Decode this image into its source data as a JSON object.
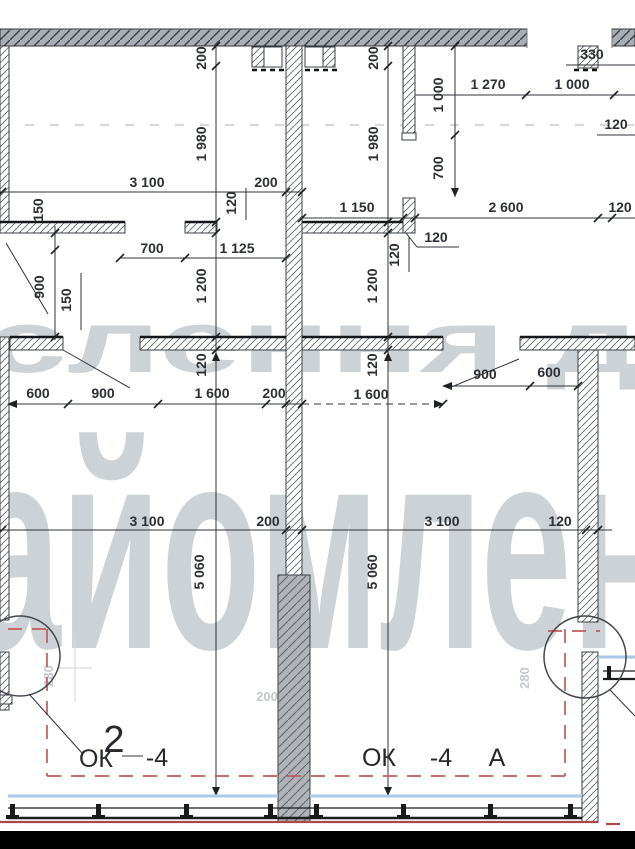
{
  "drawing": {
    "type": "architectural floor plan fragment with dimension chains",
    "watermark": {
      "line1": "слення д",
      "line2": "айомлен"
    },
    "windows": {
      "left": {
        "ok": "ОК",
        "num": "2",
        "code": "-4"
      },
      "right": {
        "ok": "ОК",
        "code": "-4",
        "letter": "А"
      }
    },
    "colors": {
      "dim_text": "#2c2f33",
      "wall_grey": "#a9aeb4",
      "pier_grey": "#b0b4b9",
      "red_dash": "#c15b5b",
      "glazing_blue": "#a9c9e8",
      "watermark_grey": "#cdd2d6",
      "letterbox_black": "#000000"
    },
    "dims": {
      "v200_l": "200",
      "v1980_l": "1 980",
      "v200_c": "200",
      "v1980_c": "1 980",
      "v1000": "1 000",
      "v700": "700",
      "h330": "330",
      "h1270": "1 270",
      "h1000": "1 000",
      "h120_tr": "120",
      "h3100_tl": "3 100",
      "h200_tl": "200",
      "v120_tl": "120",
      "h1150": "1 150",
      "h2600": "2 600",
      "h120_tr2": "120",
      "h700_door": "700",
      "h1125": "1 125",
      "h120_stub": "120",
      "v120_stub": "120",
      "v150_a": "150",
      "v900": "900",
      "v150_b": "150",
      "v1200_l": "1 200",
      "v1200_c": "1 200",
      "v120_lw": "120",
      "v120_cw": "120",
      "h600_bl": "600",
      "h900_bl": "900",
      "h1600_bl": "1 600",
      "h200_bl": "200",
      "h1600_br": "1 600",
      "h900_br": "900",
      "h600_br": "600",
      "h3100_l2": "3 100",
      "h200_l2": "200",
      "h3100_r2": "3 100",
      "h120_r2": "120",
      "v5060_l": "5 060",
      "v5060_r": "5 060",
      "f280_l": "280",
      "f280_r": "280",
      "f200": "200"
    }
  }
}
